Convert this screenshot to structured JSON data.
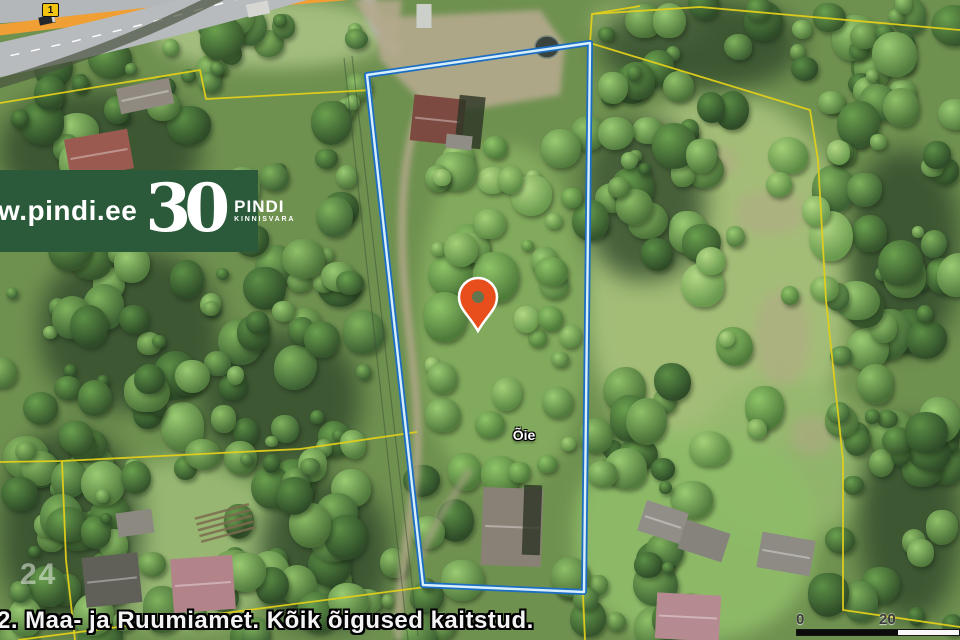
{
  "banner": {
    "url_text": "w.pindi.ee",
    "anniversary": "30",
    "brand": "PINDI",
    "brand_subtitle": "KINNISVARA",
    "bg_color": "#2a5a39"
  },
  "map": {
    "route_number": "1",
    "parcel_label": "Õie",
    "plot_number": "24",
    "attribution": "2. Maa- ja Ruumiamet. Kõik õigused kaitstud.",
    "scale_start": "0",
    "scale_mid": "20"
  },
  "colors": {
    "boundary_blue": "#1d6ec2",
    "boundary_core": "#d8f0fc",
    "cadastral_yellow": "#e2cf1a",
    "pin_orange": "#e84e1b",
    "route_badge_yellow": "#f2c40f",
    "banner_green": "#2a5a39"
  }
}
